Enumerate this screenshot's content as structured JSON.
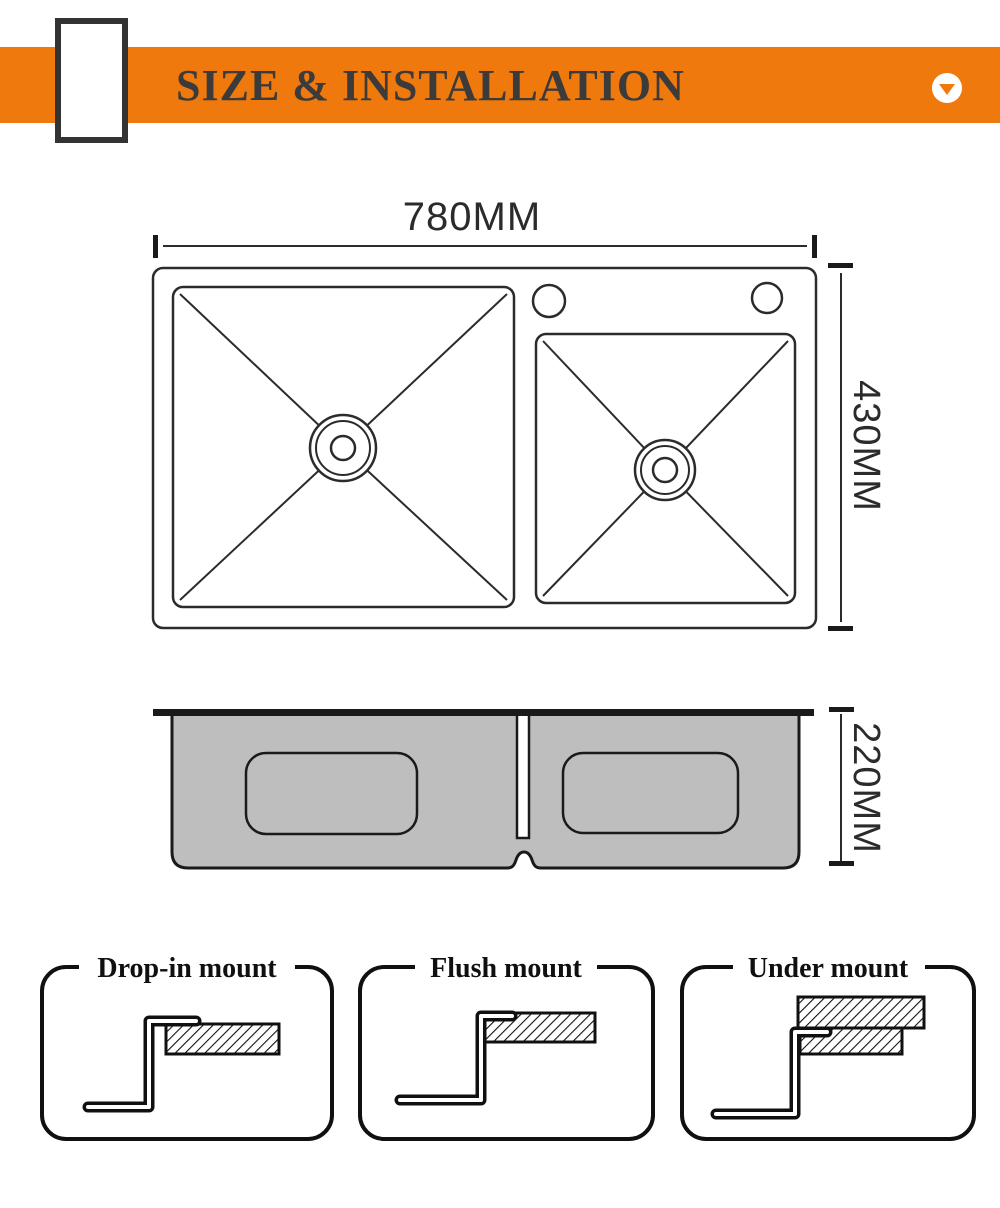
{
  "header": {
    "title": "SIZE & INSTALLATION",
    "icon": "chevron-down-circle-icon",
    "accent_color": "#F0790D",
    "title_color": "#3b3b3b"
  },
  "top_view": {
    "width_label": "780MM",
    "height_label": "430MM"
  },
  "section_view": {
    "depth_label": "220MM",
    "body_fill_color": "#BEBEBE"
  },
  "mounts": [
    {
      "label": "Drop-in mount"
    },
    {
      "label": "Flush mount"
    },
    {
      "label": "Under mount"
    }
  ],
  "colors": {
    "ink": "#2b2b2b",
    "panel_ink": "#101010",
    "background": "#ffffff"
  }
}
